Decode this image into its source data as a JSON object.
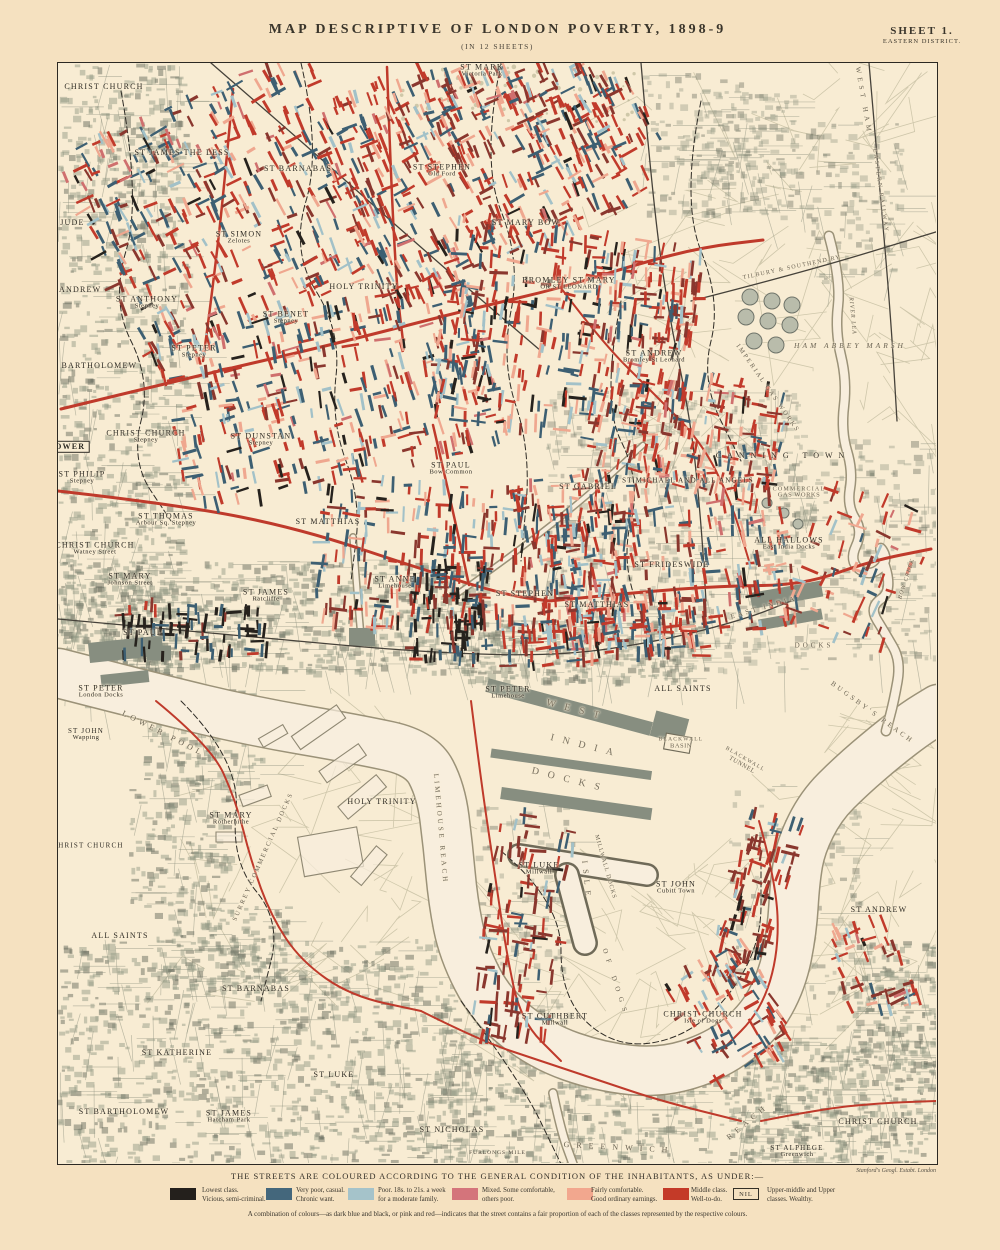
{
  "header": {
    "title": "MAP  DESCRIPTIVE  OF  LONDON  POVERTY,  1898-9",
    "subtitle": "(IN 12 SHEETS)",
    "sheet": "SHEET 1.",
    "district": "EASTERN DISTRICT."
  },
  "legend": {
    "title": "THE STREETS ARE COLOURED ACCORDING TO THE GENERAL CONDITION OF THE INHABITANTS, AS UNDER:—",
    "items": [
      {
        "color": "#24201c",
        "nil": false,
        "line1": "Lowest class.",
        "line2": "Vicious, semi-criminal."
      },
      {
        "color": "#44677c",
        "nil": false,
        "line1": "Very poor, casual.",
        "line2": "Chronic want."
      },
      {
        "color": "#a5c3ca",
        "nil": false,
        "line1": "Poor.  18s. to 21s. a week",
        "line2": "for a moderate family."
      },
      {
        "color": "#d4747b",
        "nil": false,
        "line1": "Mixed.  Some comfortable,",
        "line2": "others poor."
      },
      {
        "color": "#f2a78e",
        "nil": false,
        "line1": "Fairly comfortable.",
        "line2": "Good ordinary earnings."
      },
      {
        "color": "#c43a28",
        "nil": false,
        "line1": "Middle class.",
        "line2": "Well-to-do."
      },
      {
        "color": "",
        "nil": true,
        "nil_label": "NIL",
        "line1": "Upper-middle and Upper",
        "line2": "classes.   Wealthy."
      }
    ],
    "note": "A combination of colours—as dark blue and black, or pink and red—indicates that the street contains a fair proportion of each of the classes represented by the respective colours.",
    "publisher": "Stanford's Geogl. Estabt. London",
    "scale_label": "FURLONGS                    MILE"
  },
  "map": {
    "labels": [
      {
        "t": "CHRIST CHURCH",
        "x": 103,
        "y": 86
      },
      {
        "t": "ST JAMES THE LESS",
        "x": 181,
        "y": 152
      },
      {
        "t": "ST BARNABAS",
        "x": 297,
        "y": 168
      },
      {
        "t": "ST JUDE",
        "x": 64,
        "y": 222
      },
      {
        "t": "ST SIMON",
        "s": "Zelotes",
        "x": 238,
        "y": 237
      },
      {
        "t": "ST MARK",
        "s": "Victoria Park",
        "x": 481,
        "y": 70
      },
      {
        "t": "ST STEPHEN",
        "s": "Old Ford",
        "x": 441,
        "y": 170
      },
      {
        "t": "ST MARY BOW",
        "x": 525,
        "y": 222
      },
      {
        "t": "BROMLEY ST MARY",
        "s": "OR ST LEONARD",
        "x": 568,
        "y": 283
      },
      {
        "t": "HOLY TRINITY",
        "x": 363,
        "y": 286
      },
      {
        "t": "ST ANDREW",
        "x": 72,
        "y": 289
      },
      {
        "t": "ST ANTHONY",
        "s": "Stepney",
        "x": 146,
        "y": 302
      },
      {
        "t": "ST BENET",
        "s": "Stepney",
        "x": 285,
        "y": 317
      },
      {
        "t": "ST PETER",
        "s": "Stepney",
        "x": 193,
        "y": 351
      },
      {
        "t": "ST BARTHOLOMEW",
        "x": 91,
        "y": 365
      },
      {
        "t": "ST ANDREW",
        "s": "Bromley St Leonard",
        "x": 653,
        "y": 356
      },
      {
        "t": "CHRIST CHURCH",
        "s": "Stepney",
        "x": 145,
        "y": 436
      },
      {
        "t": "ST DUNSTAN",
        "s": "Stepney",
        "x": 260,
        "y": 439
      },
      {
        "t": "ST PHILIP",
        "s": "Stepney",
        "x": 81,
        "y": 477
      },
      {
        "t": "ST THOMAS",
        "s": "Arbour Sq. Stepney",
        "x": 165,
        "y": 519
      },
      {
        "t": "ST MATTHIAS",
        "x": 327,
        "y": 521
      },
      {
        "t": "CHRIST CHURCH",
        "s": "Watney Street",
        "x": 94,
        "y": 548
      },
      {
        "t": "ST MARY",
        "s": "Johnson Street",
        "x": 129,
        "y": 579
      },
      {
        "t": "ST JAMES",
        "s": "Ratcliffe",
        "x": 265,
        "y": 595
      },
      {
        "t": "ST PAUL",
        "x": 142,
        "y": 632
      },
      {
        "t": "ST ANNE",
        "s": "Limehouse",
        "x": 394,
        "y": 582
      },
      {
        "t": "ST PAUL",
        "s": "Bow Common",
        "x": 450,
        "y": 468
      },
      {
        "t": "ST GABRIEL",
        "x": 587,
        "y": 486
      },
      {
        "t": "ST MICHAEL AND ALL ANGELS",
        "x": 687,
        "y": 480,
        "f": 7
      },
      {
        "t": "ST STEPHEN",
        "x": 524,
        "y": 593
      },
      {
        "t": "ST MATTHIAS",
        "x": 596,
        "y": 604
      },
      {
        "t": "ST FRIDESWIDE",
        "x": 671,
        "y": 564
      },
      {
        "t": "ALL HALLOWS",
        "s": "East India Docks",
        "x": 788,
        "y": 543
      },
      {
        "t": "CANNING TOWN",
        "x": 782,
        "y": 455,
        "ls": 6
      },
      {
        "t": "ST PETER",
        "s": "London Docks",
        "x": 100,
        "y": 691
      },
      {
        "t": "ST JOHN",
        "s": "Wapping",
        "x": 85,
        "y": 734,
        "f": 7
      },
      {
        "t": "ST MARY",
        "s": "Rotherhithe",
        "x": 230,
        "y": 818
      },
      {
        "t": "CHRIST CHURCH",
        "x": 87,
        "y": 845,
        "f": 7
      },
      {
        "t": "ALL SAINTS",
        "x": 119,
        "y": 935
      },
      {
        "t": "HOLY TRINITY",
        "x": 381,
        "y": 801
      },
      {
        "t": "ST BARNABAS",
        "x": 255,
        "y": 988
      },
      {
        "t": "ST KATHERINE",
        "x": 176,
        "y": 1052
      },
      {
        "t": "ST BARTHOLOMEW",
        "x": 123,
        "y": 1111
      },
      {
        "t": "ST JAMES",
        "s": "Hatcham Park",
        "x": 228,
        "y": 1116
      },
      {
        "t": "ST LUKE",
        "x": 333,
        "y": 1074
      },
      {
        "t": "ST NICHOLAS",
        "x": 451,
        "y": 1129
      },
      {
        "t": "ST PETER",
        "s": "Limehouse",
        "x": 507,
        "y": 692
      },
      {
        "t": "ALL SAINTS",
        "x": 682,
        "y": 688
      },
      {
        "t": "ST LUKE",
        "s": "Millwall",
        "x": 538,
        "y": 868
      },
      {
        "t": "ST JOHN",
        "s": "Cubitt Town",
        "x": 675,
        "y": 887
      },
      {
        "t": "ST CUTHBERT",
        "s": "Millwall",
        "x": 554,
        "y": 1019
      },
      {
        "t": "CHRIST CHURCH",
        "s": "Isle of Dogs",
        "x": 702,
        "y": 1017
      },
      {
        "t": "ST ANDREW",
        "x": 878,
        "y": 909
      },
      {
        "t": "CHRIST CHURCH",
        "x": 877,
        "y": 1121
      },
      {
        "t": "ST ALPHEGE",
        "s": "Greenwich",
        "x": 796,
        "y": 1151,
        "f": 7
      },
      {
        "t": "TOWER",
        "x": 66,
        "y": 446,
        "st": "b"
      },
      {
        "t": "LOWER POOL",
        "x": 162,
        "y": 733,
        "r": 27,
        "ls": 4,
        "st": "w"
      },
      {
        "t": "LIMEHOUSE REACH",
        "x": 439,
        "y": 828,
        "r": 85,
        "ls": 3,
        "st": "w",
        "f": 7
      },
      {
        "t": "GREENWICH",
        "x": 618,
        "y": 1147,
        "r": 3,
        "ls": 7,
        "st": "w"
      },
      {
        "t": "REACH",
        "x": 747,
        "y": 1121,
        "r": -40,
        "ls": 5,
        "st": "w"
      },
      {
        "t": "BUGSBY'S REACH",
        "x": 871,
        "y": 712,
        "r": 36,
        "ls": 3,
        "st": "w",
        "f": 7
      },
      {
        "t": "WEST",
        "x": 576,
        "y": 710,
        "r": 14,
        "ls": 9,
        "st": "d",
        "f": 10
      },
      {
        "t": "INDIA",
        "x": 585,
        "y": 746,
        "r": 14,
        "ls": 9,
        "st": "d",
        "f": 10
      },
      {
        "t": "DOCKS",
        "x": 569,
        "y": 780,
        "r": 14,
        "ls": 9,
        "st": "d",
        "f": 10
      },
      {
        "t": "ISLE",
        "x": 585,
        "y": 880,
        "r": 84,
        "ls": 6,
        "st": "w"
      },
      {
        "t": "OF DOGS",
        "x": 614,
        "y": 982,
        "r": 72,
        "ls": 6,
        "st": "w",
        "f": 7
      },
      {
        "t": "MILLWALL DOCKS",
        "x": 604,
        "y": 866,
        "r": 74,
        "ls": 1,
        "st": "w",
        "f": 6
      },
      {
        "t": "SURREY COMMERCIAL DOCKS",
        "x": 263,
        "y": 856,
        "r": -66,
        "ls": 2,
        "st": "w",
        "f": 6.5
      },
      {
        "t": "HAM ABBEY MARSH",
        "x": 849,
        "y": 345,
        "ls": 3,
        "st": "w",
        "f": 7.5,
        "i": 1
      },
      {
        "t": "IMPERIAL GAS WORKS",
        "x": 766,
        "y": 388,
        "r": 55,
        "ls": 2,
        "st": "w",
        "f": 6.5
      },
      {
        "t": "COMMERCIAL",
        "s": "GAS WORKS",
        "x": 798,
        "y": 492,
        "st": "w",
        "f": 6
      },
      {
        "t": "EAST INDIA",
        "x": 763,
        "y": 607,
        "r": -16,
        "ls": 3,
        "st": "w",
        "f": 7
      },
      {
        "t": "DOCKS",
        "x": 813,
        "y": 645,
        "ls": 3,
        "st": "w",
        "f": 7
      },
      {
        "t": "BLACKWALL",
        "s": "BASIN",
        "x": 680,
        "y": 743,
        "st": "w",
        "f": 5.5
      },
      {
        "t": "TILBURY & SOUTHEND RY",
        "x": 791,
        "y": 267,
        "r": -12,
        "st": "w",
        "f": 6
      },
      {
        "t": "EASTERN RAILWAY",
        "x": 879,
        "y": 190,
        "r": 82,
        "st": "w",
        "f": 6,
        "ls": 2
      },
      {
        "t": "RIVER LEA",
        "x": 851,
        "y": 315,
        "r": 85,
        "st": "w",
        "f": 6,
        "ls": 1,
        "i": 1
      },
      {
        "t": "BOW CREEK",
        "x": 906,
        "y": 578,
        "r": -72,
        "st": "w",
        "f": 6,
        "ls": 1,
        "i": 1
      },
      {
        "t": "WEST HAM",
        "x": 862,
        "y": 100,
        "r": 80,
        "st": "w",
        "f": 7,
        "ls": 4
      },
      {
        "t": "BLACKWALL",
        "s": "TUNNEL",
        "x": 742,
        "y": 762,
        "r": 30,
        "st": "w",
        "f": 5.5
      }
    ]
  }
}
